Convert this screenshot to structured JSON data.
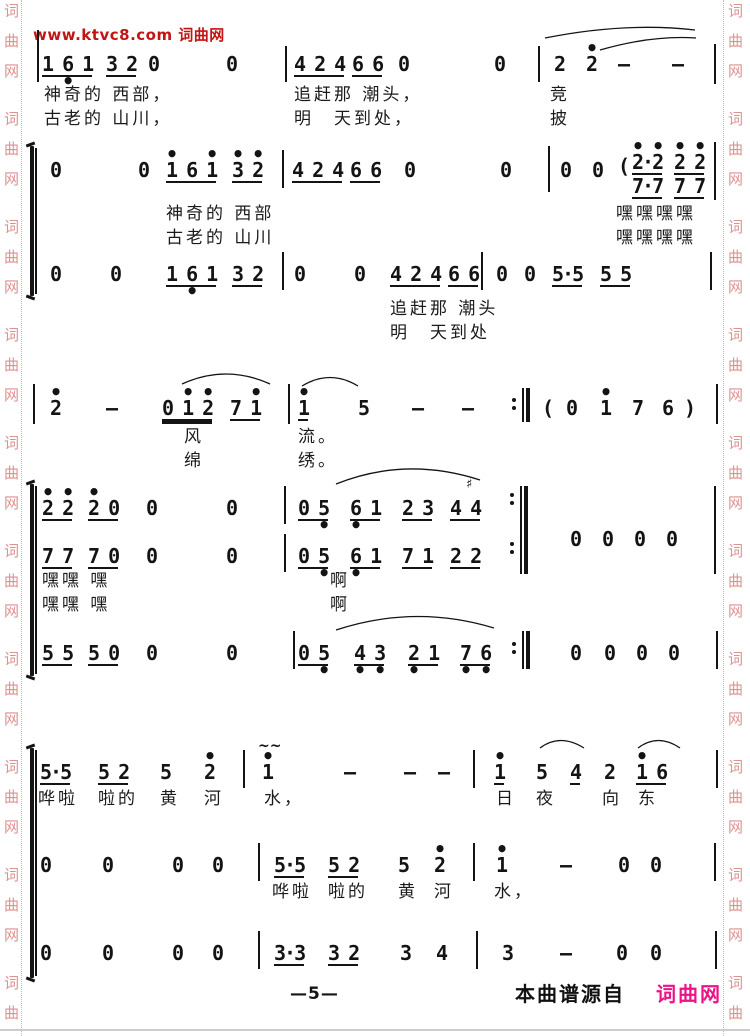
{
  "watermarks": {
    "top": {
      "text": "www.ktvc8.com 词曲网",
      "x": 33,
      "y": 24,
      "color": "#c31414"
    },
    "side_chars": [
      "词",
      "曲",
      "网"
    ],
    "side_color": "#dd9292",
    "left_col_x": 4,
    "right_col_x": 728,
    "left_dot_x": 21,
    "right_dot_x": 723,
    "groups_start_y": 4,
    "group_period": 108,
    "char_gap": 30,
    "group_count": 10
  },
  "footer": {
    "page_number": "—5—",
    "page_number_x": 290,
    "page_number_y": 984,
    "source_text": "本曲谱源自",
    "source_x": 515,
    "source_y": 978,
    "brand_text": "词曲网",
    "brand_x": 656,
    "brand_y": 978,
    "brand_color": "#ee1289"
  },
  "score": {
    "ink": "#141414",
    "brackets": [
      {
        "x": 30,
        "y": 146,
        "h": 150
      },
      {
        "x": 30,
        "y": 484,
        "h": 192
      },
      {
        "x": 30,
        "y": 748,
        "h": 230
      }
    ],
    "barlines": [
      {
        "x": 37,
        "y": 30,
        "h": 52
      },
      {
        "x": 285,
        "y": 46,
        "h": 36
      },
      {
        "x": 538,
        "y": 46,
        "h": 36
      },
      {
        "x": 714,
        "y": 44,
        "h": 40
      },
      {
        "x": 35,
        "y": 148,
        "h": 146
      },
      {
        "x": 282,
        "y": 150,
        "h": 38
      },
      {
        "x": 548,
        "y": 146,
        "h": 46
      },
      {
        "x": 714,
        "y": 142,
        "h": 58
      },
      {
        "x": 282,
        "y": 252,
        "h": 38
      },
      {
        "x": 481,
        "y": 252,
        "h": 38
      },
      {
        "x": 710,
        "y": 252,
        "h": 38
      },
      {
        "x": 33,
        "y": 384,
        "h": 40
      },
      {
        "x": 288,
        "y": 384,
        "h": 40
      },
      {
        "x": 716,
        "y": 384,
        "h": 40
      },
      {
        "x": 35,
        "y": 486,
        "h": 188
      },
      {
        "x": 284,
        "y": 486,
        "h": 38
      },
      {
        "x": 284,
        "y": 534,
        "h": 38
      },
      {
        "x": 714,
        "y": 486,
        "h": 88
      },
      {
        "x": 293,
        "y": 631,
        "h": 38
      },
      {
        "x": 716,
        "y": 631,
        "h": 38
      },
      {
        "x": 35,
        "y": 750,
        "h": 226
      },
      {
        "x": 243,
        "y": 750,
        "h": 38
      },
      {
        "x": 473,
        "y": 750,
        "h": 38
      },
      {
        "x": 716,
        "y": 750,
        "h": 38
      },
      {
        "x": 258,
        "y": 843,
        "h": 38
      },
      {
        "x": 473,
        "y": 843,
        "h": 38
      },
      {
        "x": 714,
        "y": 843,
        "h": 38
      },
      {
        "x": 258,
        "y": 931,
        "h": 38
      },
      {
        "x": 476,
        "y": 931,
        "h": 38
      },
      {
        "x": 715,
        "y": 931,
        "h": 38
      }
    ],
    "cells": [
      {
        "x": 42,
        "y": 44,
        "t": "1 6 1",
        "u": 1,
        "b": "  •  "
      },
      {
        "x": 106,
        "y": 44,
        "t": "3 2",
        "u": 1
      },
      {
        "x": 148,
        "y": 44,
        "t": "0"
      },
      {
        "x": 226,
        "y": 44,
        "t": "0"
      },
      {
        "x": 294,
        "y": 44,
        "t": "4 2 4",
        "u": 1
      },
      {
        "x": 352,
        "y": 44,
        "t": "6 6",
        "u": 1
      },
      {
        "x": 398,
        "y": 44,
        "t": "0"
      },
      {
        "x": 494,
        "y": 44,
        "t": "0"
      },
      {
        "x": 554,
        "y": 44,
        "t": "2"
      },
      {
        "x": 586,
        "y": 44,
        "t": "2",
        "a": "•"
      },
      {
        "x": 618,
        "y": 44,
        "t": "—"
      },
      {
        "x": 672,
        "y": 44,
        "t": "—"
      },
      {
        "x": 50,
        "y": 150,
        "t": "0"
      },
      {
        "x": 138,
        "y": 150,
        "t": "0"
      },
      {
        "x": 166,
        "y": 150,
        "t": "1 6 1",
        "u": 1,
        "a": "•   •"
      },
      {
        "x": 232,
        "y": 150,
        "t": "3 2",
        "u": 1,
        "a": "• •"
      },
      {
        "x": 292,
        "y": 150,
        "t": "4 2 4",
        "u": 1
      },
      {
        "x": 350,
        "y": 150,
        "t": "6 6",
        "u": 1
      },
      {
        "x": 404,
        "y": 150,
        "t": "0"
      },
      {
        "x": 500,
        "y": 150,
        "t": "0"
      },
      {
        "x": 560,
        "y": 150,
        "t": "0"
      },
      {
        "x": 592,
        "y": 150,
        "t": "0"
      },
      {
        "x": 618,
        "y": 146,
        "t": "("
      },
      {
        "x": 632,
        "y": 142,
        "t": "2·2",
        "u": 1,
        "a": "• •"
      },
      {
        "x": 674,
        "y": 142,
        "t": "2 2",
        "u": 1,
        "a": "• •"
      },
      {
        "x": 632,
        "y": 166,
        "t": "7·7",
        "u": 1
      },
      {
        "x": 674,
        "y": 166,
        "t": "7 7",
        "u": 1
      },
      {
        "x": 50,
        "y": 254,
        "t": "0"
      },
      {
        "x": 110,
        "y": 254,
        "t": "0"
      },
      {
        "x": 166,
        "y": 254,
        "t": "1 6 1",
        "u": 1,
        "b": "  •  "
      },
      {
        "x": 232,
        "y": 254,
        "t": "3 2",
        "u": 1
      },
      {
        "x": 294,
        "y": 254,
        "t": "0"
      },
      {
        "x": 354,
        "y": 254,
        "t": "0"
      },
      {
        "x": 390,
        "y": 254,
        "t": "4 2 4",
        "u": 1
      },
      {
        "x": 448,
        "y": 254,
        "t": "6 6",
        "u": 1
      },
      {
        "x": 496,
        "y": 254,
        "t": "0"
      },
      {
        "x": 524,
        "y": 254,
        "t": "0"
      },
      {
        "x": 552,
        "y": 254,
        "t": "5·5",
        "u": 1
      },
      {
        "x": 600,
        "y": 254,
        "t": "5 5",
        "u": 1
      },
      {
        "x": 50,
        "y": 388,
        "t": "2",
        "a": "•"
      },
      {
        "x": 106,
        "y": 388,
        "t": "—"
      },
      {
        "x": 162,
        "y": 388,
        "t": "0 1 2",
        "u": 2,
        "a": "  • •"
      },
      {
        "x": 230,
        "y": 388,
        "t": "7 1",
        "u": 1,
        "a": "  •"
      },
      {
        "x": 298,
        "y": 388,
        "t": "1",
        "u": 1,
        "a": "•"
      },
      {
        "x": 358,
        "y": 388,
        "t": "5"
      },
      {
        "x": 412,
        "y": 388,
        "t": "—"
      },
      {
        "x": 462,
        "y": 388,
        "t": "—"
      },
      {
        "x": 542,
        "y": 388,
        "t": "("
      },
      {
        "x": 566,
        "y": 388,
        "t": "0"
      },
      {
        "x": 600,
        "y": 388,
        "t": "1",
        "a": "•"
      },
      {
        "x": 632,
        "y": 388,
        "t": "7"
      },
      {
        "x": 662,
        "y": 388,
        "t": "6"
      },
      {
        "x": 684,
        "y": 388,
        "t": ")"
      },
      {
        "x": 42,
        "y": 488,
        "t": "2 2",
        "u": 1,
        "a": "• •"
      },
      {
        "x": 88,
        "y": 488,
        "t": "2 0",
        "u": 1,
        "a": "•  "
      },
      {
        "x": 146,
        "y": 488,
        "t": "0"
      },
      {
        "x": 226,
        "y": 488,
        "t": "0"
      },
      {
        "x": 298,
        "y": 488,
        "t": "0 5",
        "u": 1,
        "b": "  •"
      },
      {
        "x": 350,
        "y": 488,
        "t": "6 1",
        "u": 1,
        "b": "•  "
      },
      {
        "x": 402,
        "y": 488,
        "t": "2 3",
        "u": 1
      },
      {
        "x": 450,
        "y": 488,
        "t": "4 4",
        "u": 1
      },
      {
        "x": 570,
        "y": 519,
        "t": "0"
      },
      {
        "x": 602,
        "y": 519,
        "t": "0"
      },
      {
        "x": 634,
        "y": 519,
        "t": "0"
      },
      {
        "x": 666,
        "y": 519,
        "t": "0"
      },
      {
        "x": 42,
        "y": 536,
        "t": "7 7",
        "u": 1
      },
      {
        "x": 88,
        "y": 536,
        "t": "7 0",
        "u": 1
      },
      {
        "x": 146,
        "y": 536,
        "t": "0"
      },
      {
        "x": 226,
        "y": 536,
        "t": "0"
      },
      {
        "x": 298,
        "y": 536,
        "t": "0 5",
        "u": 1,
        "b": "  •"
      },
      {
        "x": 350,
        "y": 536,
        "t": "6 1",
        "u": 1,
        "b": "•  "
      },
      {
        "x": 402,
        "y": 536,
        "t": "7 1",
        "u": 1
      },
      {
        "x": 450,
        "y": 536,
        "t": "2 2",
        "u": 1
      },
      {
        "x": 42,
        "y": 633,
        "t": "5 5",
        "u": 1
      },
      {
        "x": 88,
        "y": 633,
        "t": "5 0",
        "u": 1
      },
      {
        "x": 146,
        "y": 633,
        "t": "0"
      },
      {
        "x": 226,
        "y": 633,
        "t": "0"
      },
      {
        "x": 298,
        "y": 633,
        "t": "0 5",
        "u": 1,
        "b": "  •"
      },
      {
        "x": 354,
        "y": 633,
        "t": "4 3",
        "u": 1,
        "b": "• •"
      },
      {
        "x": 408,
        "y": 633,
        "t": "2 1",
        "u": 1,
        "b": "•  "
      },
      {
        "x": 460,
        "y": 633,
        "t": "7 6",
        "u": 1,
        "b": "• •"
      },
      {
        "x": 570,
        "y": 633,
        "t": "0"
      },
      {
        "x": 604,
        "y": 633,
        "t": "0"
      },
      {
        "x": 636,
        "y": 633,
        "t": "0"
      },
      {
        "x": 668,
        "y": 633,
        "t": "0"
      },
      {
        "x": 40,
        "y": 752,
        "t": "5·5",
        "u": 1
      },
      {
        "x": 98,
        "y": 752,
        "t": "5 2",
        "u": 1
      },
      {
        "x": 160,
        "y": 752,
        "t": "5"
      },
      {
        "x": 204,
        "y": 752,
        "t": "2",
        "a": "•"
      },
      {
        "x": 262,
        "y": 752,
        "t": "1",
        "a": "•"
      },
      {
        "x": 344,
        "y": 752,
        "t": "—"
      },
      {
        "x": 404,
        "y": 752,
        "t": "—"
      },
      {
        "x": 438,
        "y": 752,
        "t": "—"
      },
      {
        "x": 494,
        "y": 752,
        "t": "1",
        "u": 1,
        "a": "•"
      },
      {
        "x": 536,
        "y": 752,
        "t": "5"
      },
      {
        "x": 570,
        "y": 752,
        "t": "4",
        "u": 1
      },
      {
        "x": 604,
        "y": 752,
        "t": "2"
      },
      {
        "x": 636,
        "y": 752,
        "t": "1 6",
        "u": 1,
        "a": "•  "
      },
      {
        "x": 40,
        "y": 845,
        "t": "0"
      },
      {
        "x": 102,
        "y": 845,
        "t": "0"
      },
      {
        "x": 172,
        "y": 845,
        "t": "0"
      },
      {
        "x": 212,
        "y": 845,
        "t": "0"
      },
      {
        "x": 274,
        "y": 845,
        "t": "5·5",
        "u": 1
      },
      {
        "x": 328,
        "y": 845,
        "t": "5 2",
        "u": 1
      },
      {
        "x": 398,
        "y": 845,
        "t": "5"
      },
      {
        "x": 434,
        "y": 845,
        "t": "2",
        "a": "•"
      },
      {
        "x": 496,
        "y": 845,
        "t": "1",
        "a": "•"
      },
      {
        "x": 560,
        "y": 845,
        "t": "—"
      },
      {
        "x": 618,
        "y": 845,
        "t": "0"
      },
      {
        "x": 650,
        "y": 845,
        "t": "0"
      },
      {
        "x": 40,
        "y": 933,
        "t": "0"
      },
      {
        "x": 102,
        "y": 933,
        "t": "0"
      },
      {
        "x": 172,
        "y": 933,
        "t": "0"
      },
      {
        "x": 212,
        "y": 933,
        "t": "0"
      },
      {
        "x": 274,
        "y": 933,
        "t": "3·3",
        "u": 1
      },
      {
        "x": 328,
        "y": 933,
        "t": "3 2",
        "u": 1
      },
      {
        "x": 400,
        "y": 933,
        "t": "3"
      },
      {
        "x": 436,
        "y": 933,
        "t": "4"
      },
      {
        "x": 502,
        "y": 933,
        "t": "3"
      },
      {
        "x": 560,
        "y": 933,
        "t": "—"
      },
      {
        "x": 616,
        "y": 933,
        "t": "0"
      },
      {
        "x": 650,
        "y": 933,
        "t": "0"
      }
    ],
    "marks": [
      {
        "x": 466,
        "y": 477,
        "t": "♯",
        "size": 13
      },
      {
        "x": 258,
        "y": 738,
        "t": "~~",
        "size": 14
      }
    ],
    "reps": [
      {
        "x": 512,
        "y": 388,
        "h": 34,
        "dots": [
          405
        ]
      },
      {
        "x": 510,
        "y": 486,
        "h": 88,
        "dots": [
          500,
          549
        ]
      },
      {
        "x": 512,
        "y": 631,
        "h": 38,
        "dots": [
          649
        ]
      }
    ],
    "slurs": [
      {
        "x1": 545,
        "y1": 38,
        "cx": 625,
        "cy": 22,
        "x2": 695,
        "y2": 30
      },
      {
        "x1": 600,
        "y1": 50,
        "cx": 652,
        "cy": 35,
        "x2": 696,
        "y2": 38
      },
      {
        "x1": 182,
        "y1": 384,
        "cx": 226,
        "cy": 364,
        "x2": 270,
        "y2": 384
      },
      {
        "x1": 302,
        "y1": 386,
        "cx": 330,
        "cy": 369,
        "x2": 358,
        "y2": 386
      },
      {
        "x1": 336,
        "y1": 484,
        "cx": 406,
        "cy": 456,
        "x2": 480,
        "y2": 480
      },
      {
        "x1": 336,
        "y1": 630,
        "cx": 415,
        "cy": 604,
        "x2": 494,
        "y2": 628
      },
      {
        "x1": 540,
        "y1": 748,
        "cx": 560,
        "cy": 733,
        "x2": 584,
        "y2": 748
      },
      {
        "x1": 638,
        "y1": 748,
        "cx": 658,
        "cy": 733,
        "x2": 680,
        "y2": 748
      }
    ],
    "lyrics": [
      {
        "x": 44,
        "y": 84,
        "t": "神奇的 西部，"
      },
      {
        "x": 294,
        "y": 84,
        "t": "追赶那 潮头，"
      },
      {
        "x": 550,
        "y": 84,
        "t": "竞"
      },
      {
        "x": 44,
        "y": 108,
        "t": "古老的 山川，"
      },
      {
        "x": 294,
        "y": 108,
        "t": "明　天到处，"
      },
      {
        "x": 550,
        "y": 108,
        "t": "披"
      },
      {
        "x": 166,
        "y": 203,
        "t": "神奇的 西部"
      },
      {
        "x": 616,
        "y": 203,
        "t": "嘿嘿嘿嘿"
      },
      {
        "x": 166,
        "y": 227,
        "t": "古老的 山川"
      },
      {
        "x": 616,
        "y": 227,
        "t": "嘿嘿嘿嘿"
      },
      {
        "x": 390,
        "y": 298,
        "t": "追赶那 潮头"
      },
      {
        "x": 390,
        "y": 322,
        "t": "明　天到处"
      },
      {
        "x": 184,
        "y": 426,
        "t": "风"
      },
      {
        "x": 298,
        "y": 426,
        "t": "流。"
      },
      {
        "x": 184,
        "y": 450,
        "t": "绵"
      },
      {
        "x": 298,
        "y": 450,
        "t": "绣。"
      },
      {
        "x": 42,
        "y": 570,
        "t": "嘿嘿 嘿"
      },
      {
        "x": 330,
        "y": 570,
        "t": "啊"
      },
      {
        "x": 42,
        "y": 594,
        "t": "嘿嘿 嘿"
      },
      {
        "x": 330,
        "y": 594,
        "t": "啊"
      },
      {
        "x": 38,
        "y": 788,
        "t": "哗啦"
      },
      {
        "x": 98,
        "y": 788,
        "t": "啦的"
      },
      {
        "x": 160,
        "y": 788,
        "t": "黄"
      },
      {
        "x": 204,
        "y": 788,
        "t": "河"
      },
      {
        "x": 264,
        "y": 788,
        "t": "水，"
      },
      {
        "x": 496,
        "y": 788,
        "t": "日"
      },
      {
        "x": 536,
        "y": 788,
        "t": "夜"
      },
      {
        "x": 602,
        "y": 788,
        "t": "向"
      },
      {
        "x": 638,
        "y": 788,
        "t": "东"
      },
      {
        "x": 272,
        "y": 881,
        "t": "哗啦"
      },
      {
        "x": 328,
        "y": 881,
        "t": "啦的"
      },
      {
        "x": 398,
        "y": 881,
        "t": "黄"
      },
      {
        "x": 434,
        "y": 881,
        "t": "河"
      },
      {
        "x": 494,
        "y": 881,
        "t": "水，"
      }
    ]
  }
}
